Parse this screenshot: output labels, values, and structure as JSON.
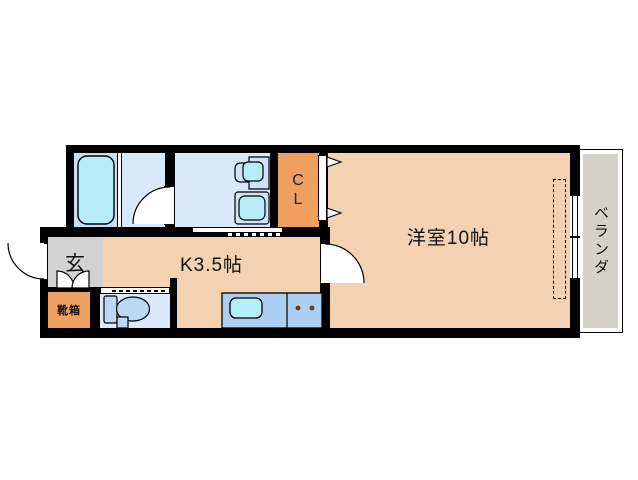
{
  "rooms": {
    "entrance": {
      "label": "玄"
    },
    "shoe_box": {
      "label": "靴箱"
    },
    "kitchen": {
      "label": "K3.5帖"
    },
    "western_room": {
      "label": "洋室10帖"
    },
    "closet": {
      "label_line1": "C",
      "label_line2": "L"
    },
    "veranda": {
      "label": "ベランダ"
    }
  },
  "colors": {
    "wall": "#000000",
    "main_floor_peach": "#f2d2b0",
    "accent_orange": "#ef9f5f",
    "entrance_gray": "#d2d2d2",
    "veranda_gray": "#d4d1cb",
    "bath_blue": "#c9def4",
    "wet_room_blue": "#d9e9fb",
    "counter_blue": "#abcef1",
    "fixture_cyan": "#b6edf8",
    "toilet_blue": "#bdd8f3",
    "burner_brown": "#7b3413"
  }
}
